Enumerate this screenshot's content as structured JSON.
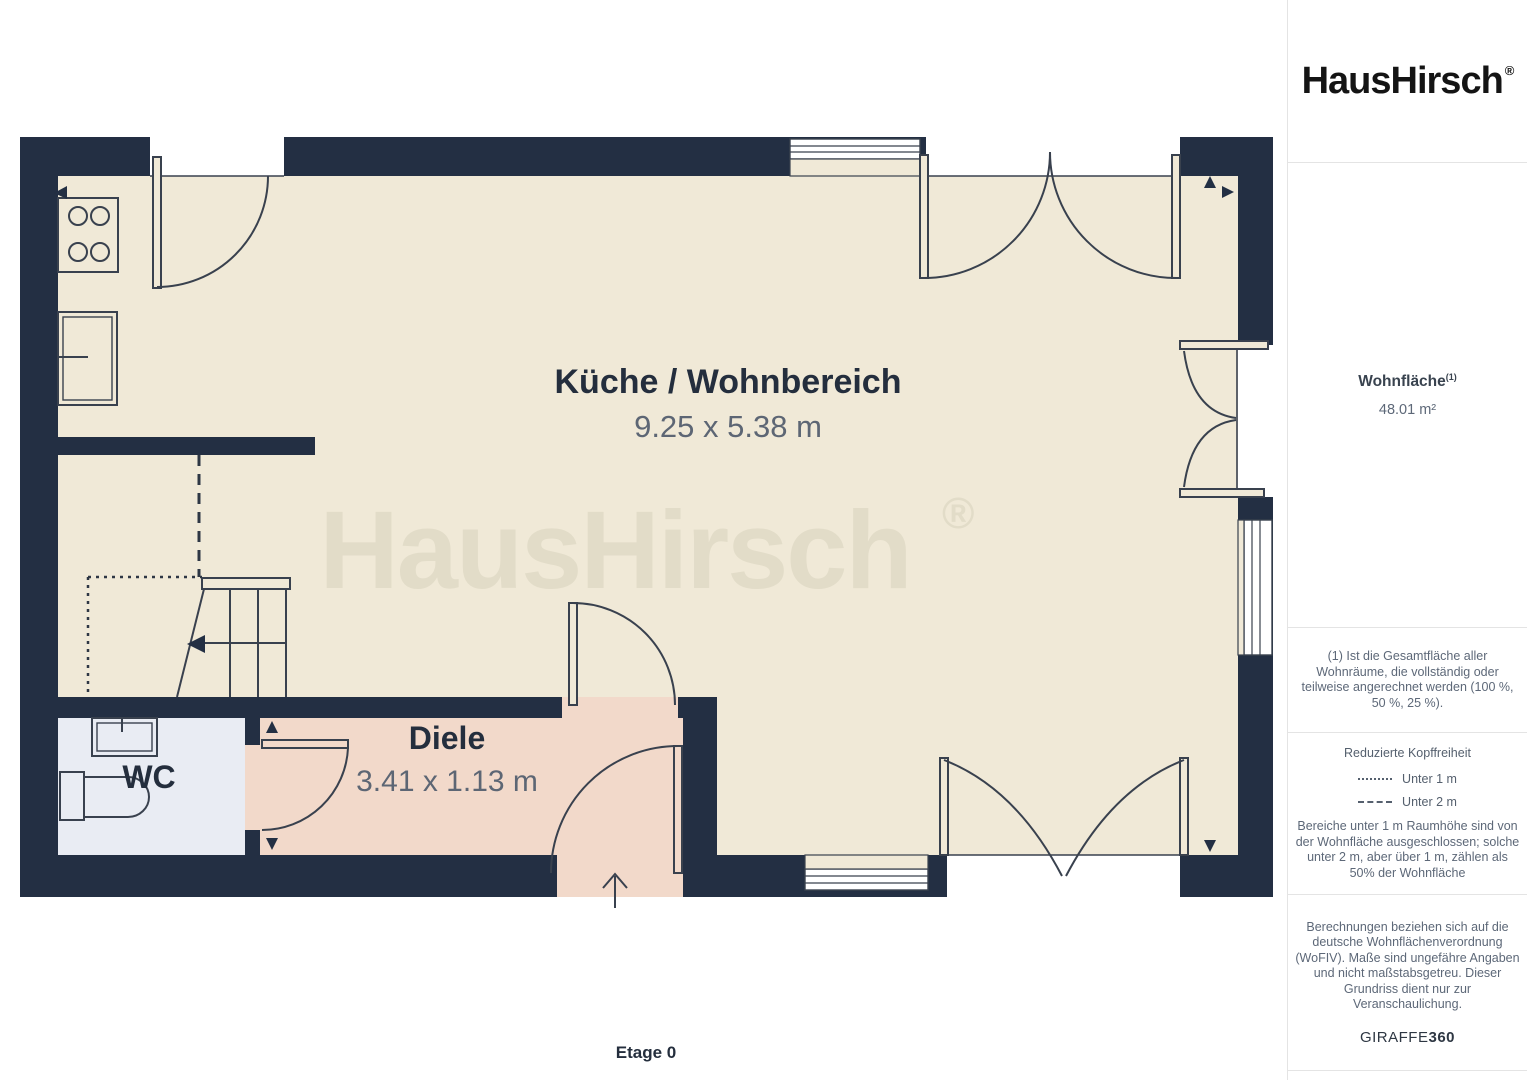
{
  "sidebar": {
    "logo": {
      "text": "HausHirsch",
      "registered": "®"
    },
    "area": {
      "label": "Wohnfläche",
      "superscript": "(1)",
      "value": "48.01 m²"
    },
    "footnote": "(1) Ist die Gesamtfläche aller Wohnräume, die vollständig oder teilweise angerechnet werden (100 %, 50 %, 25 %).",
    "headroom": {
      "title": "Reduzierte Kopffreiheit",
      "legend": [
        {
          "style": "dotted",
          "label": "Unter 1 m"
        },
        {
          "style": "dashed",
          "label": "Unter 2 m"
        }
      ],
      "note": "Bereiche unter 1 m Raumhöhe sind von der Wohnfläche ausgeschlossen; solche unter 2 m, aber über 1 m, zählen als 50% der Wohnfläche"
    },
    "disclaimer": "Berechnungen beziehen sich auf die deutsche Wohnflächenverordnung (WoFIV). Maße sind ungefähre Angaben und nicht maßstabsgetreu. Dieser Grundriss dient nur zur Veranschaulichung.",
    "brand": {
      "giraffe": "GIRAFFE",
      "threesixty": "360"
    }
  },
  "floorplan": {
    "floor_label": "Etage 0",
    "watermark": {
      "text": "HausHirsch",
      "registered": "®"
    },
    "rooms": [
      {
        "name": "Küche / Wohnbereich",
        "dimensions": "9.25 x 5.38 m"
      },
      {
        "name": "Diele",
        "dimensions": "3.41 x 1.13 m"
      },
      {
        "name": "WC",
        "dimensions": ""
      }
    ],
    "colors": {
      "wall": "#232f43",
      "floor": "#f0e9d7",
      "hall": "#f2d9ca",
      "wc": "#e9ecf3",
      "watermark": "#e2dcc8",
      "line": "#39414e",
      "room_label": "#242e3d",
      "dimension_label": "#5d6674"
    }
  }
}
